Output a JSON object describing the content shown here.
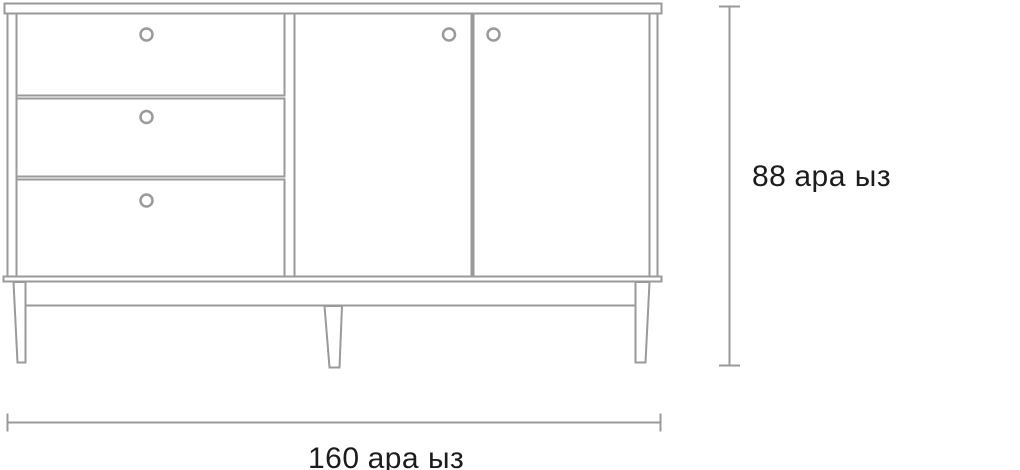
{
  "drawing": {
    "title": "sideboard-front-elevation",
    "dimensions": {
      "width": {
        "value": "160",
        "unit": "ара ыз",
        "text": "160 ара ыз"
      },
      "height": {
        "value": "88",
        "unit": "ара ыз",
        "text": "88 ара ыз"
      }
    },
    "colors": {
      "line": "#9a9a9a",
      "text": "#1c1c1c",
      "background": "#ffffff"
    }
  }
}
